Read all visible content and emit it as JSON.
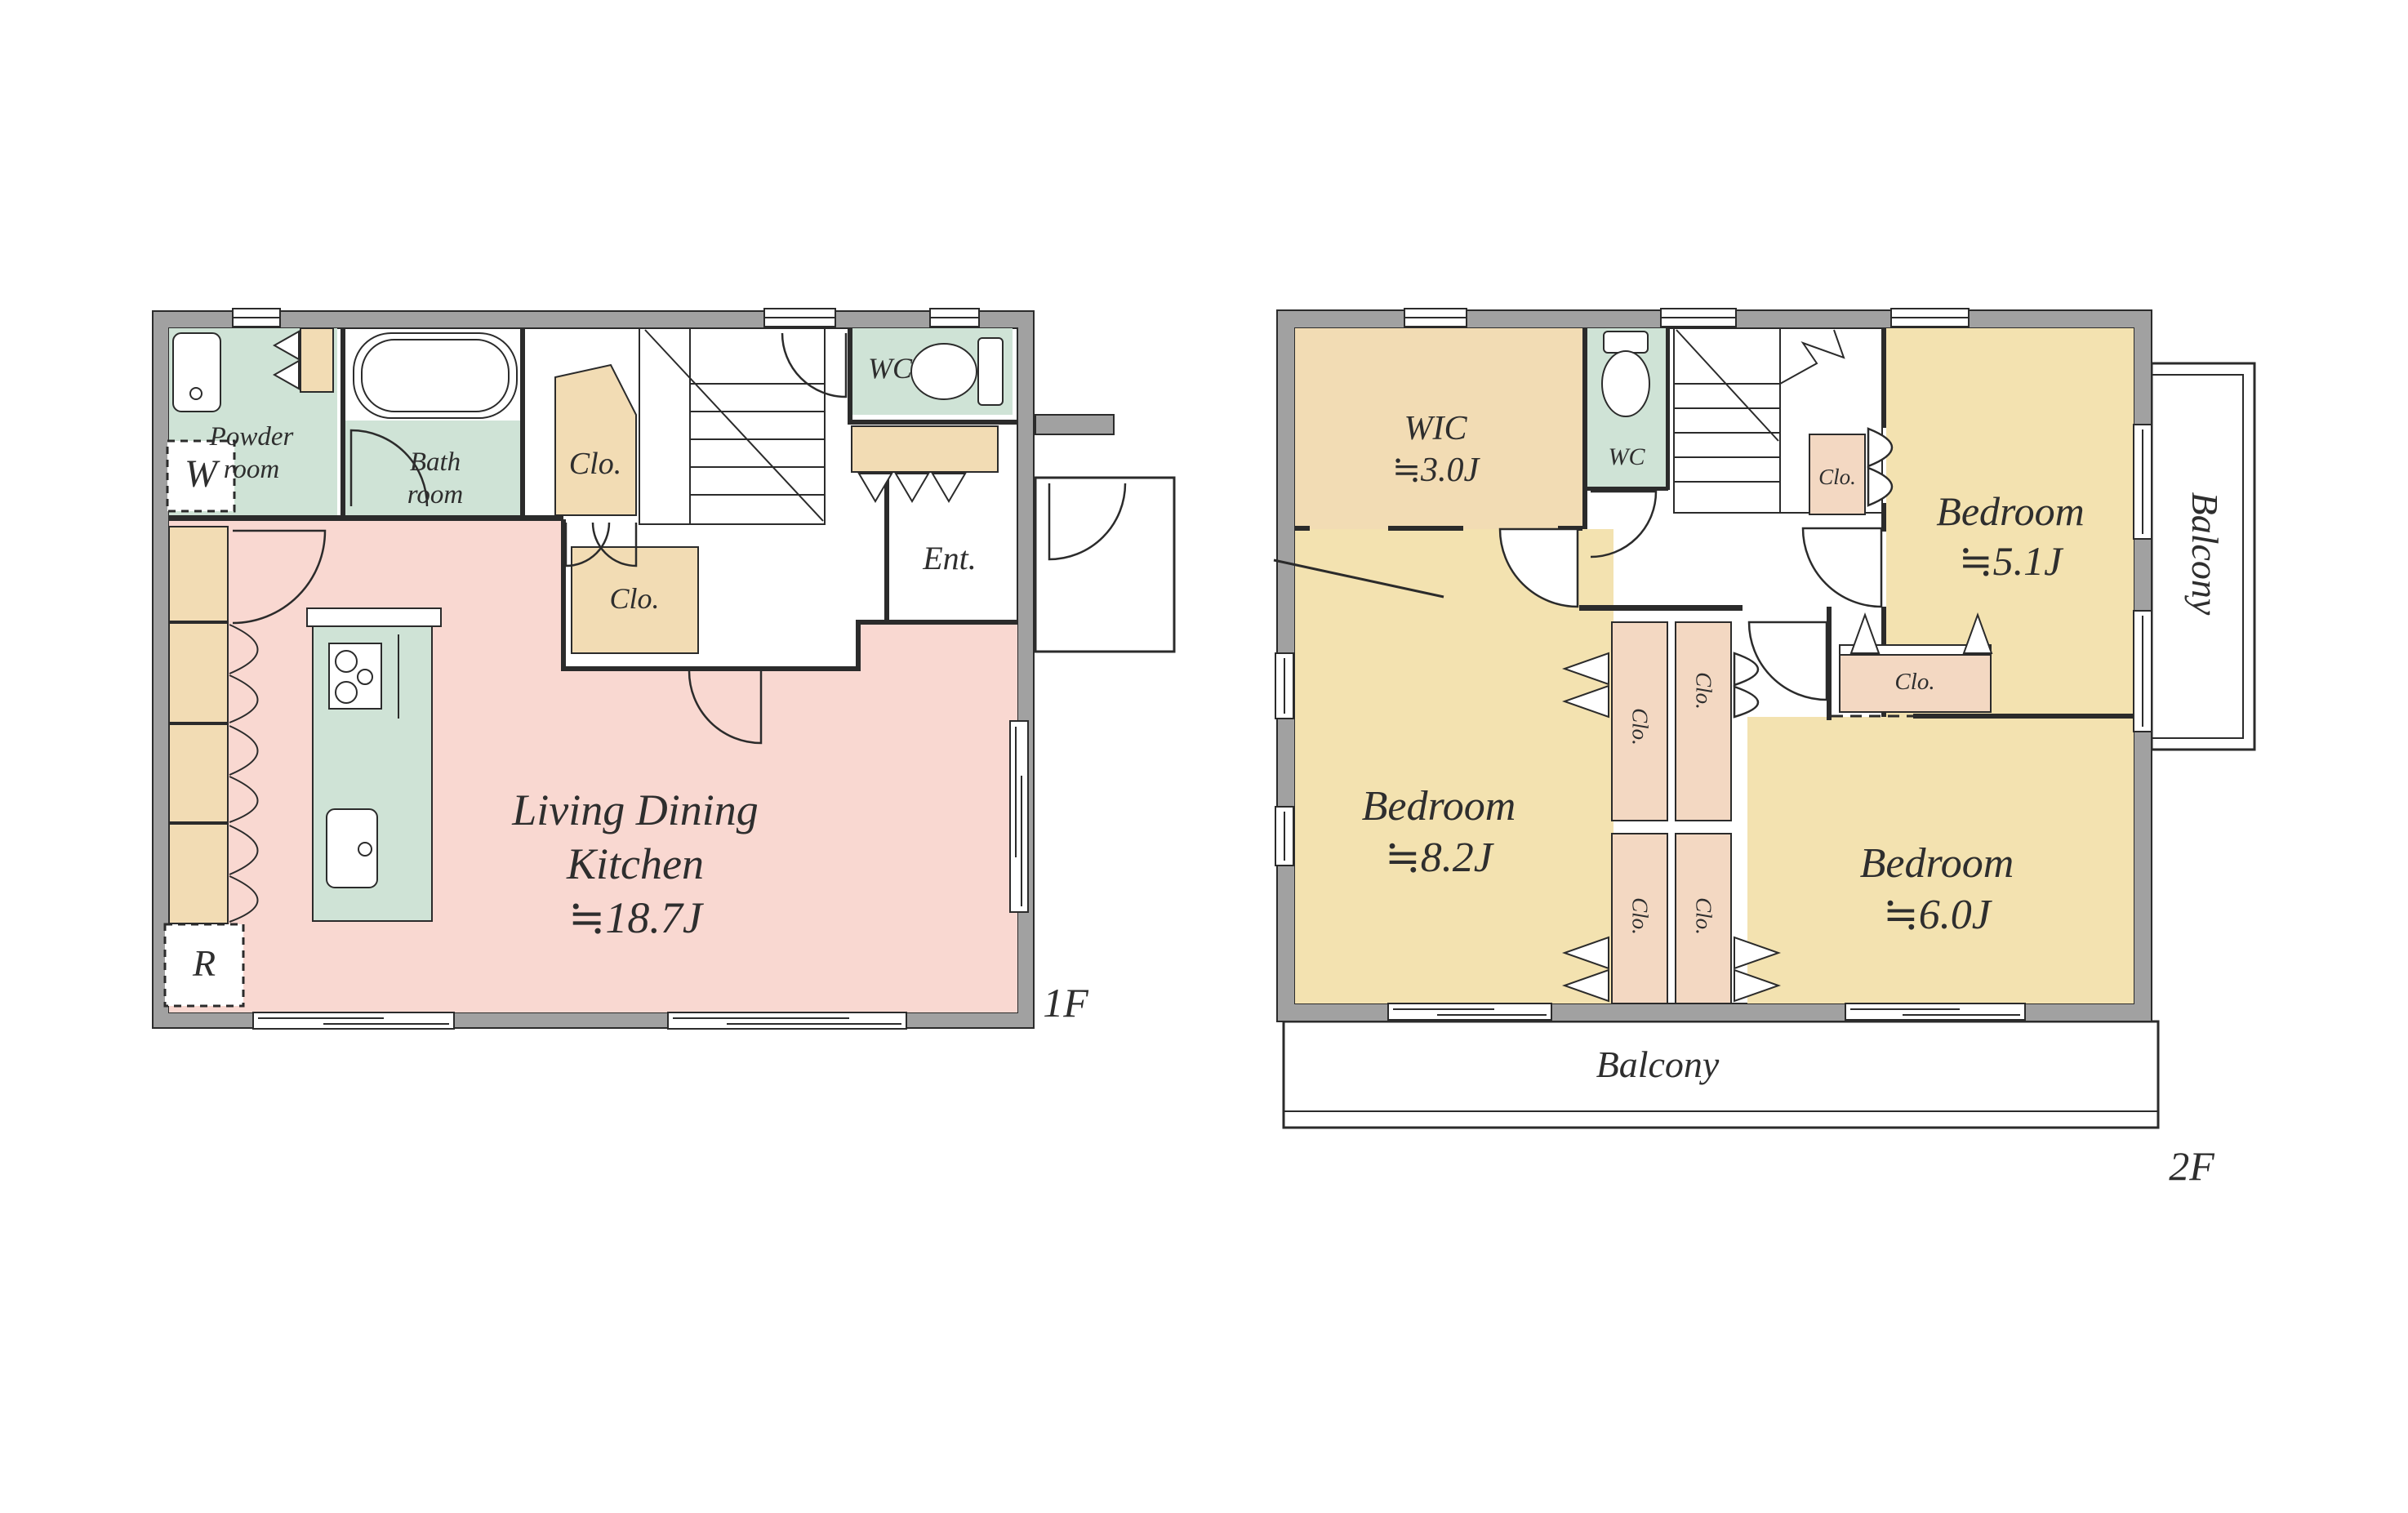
{
  "palette": {
    "wall": "#a1a1a1",
    "line": "#2b2b2b",
    "pink": "#f9d8d1",
    "green": "#cfe3d6",
    "yellow": "#f3e2b0",
    "beige": "#f2dcb4",
    "beige2": "#f3d8c2",
    "text": "#2e2e2e"
  },
  "floor1": {
    "floor_label": "1F",
    "ldk": {
      "line1": "Living Dining",
      "line2": "Kitchen",
      "size": "≒18.7J"
    },
    "powder_room": {
      "line1": "Powder",
      "line2": "room"
    },
    "bath_room": {
      "line1": "Bath",
      "line2": "room"
    },
    "wc": "WC",
    "closet_upper": "Clo.",
    "closet_lower": "Clo.",
    "entrance": "Ent.",
    "washing_machine": "W",
    "refrigerator": "R"
  },
  "floor2": {
    "floor_label": "2F",
    "wic": {
      "line1": "WIC",
      "size": "≒3.0J"
    },
    "wc": "WC",
    "closet_by_stairs": "Clo.",
    "bedroom_5_1": {
      "line1": "Bedroom",
      "size": "≒5.1J"
    },
    "closet_bedroom_5_1": "Clo.",
    "bedroom_8_2": {
      "line1": "Bedroom",
      "size": "≒8.2J"
    },
    "bedroom_6_0": {
      "line1": "Bedroom",
      "size": "≒6.0J"
    },
    "closet_strip_left_top": "Clo.",
    "closet_strip_left_bottom": "Clo.",
    "closet_strip_right_top": "Clo.",
    "closet_strip_right_bottom": "Clo.",
    "balcony_right": "Balcony",
    "balcony_bottom": "Balcony"
  }
}
